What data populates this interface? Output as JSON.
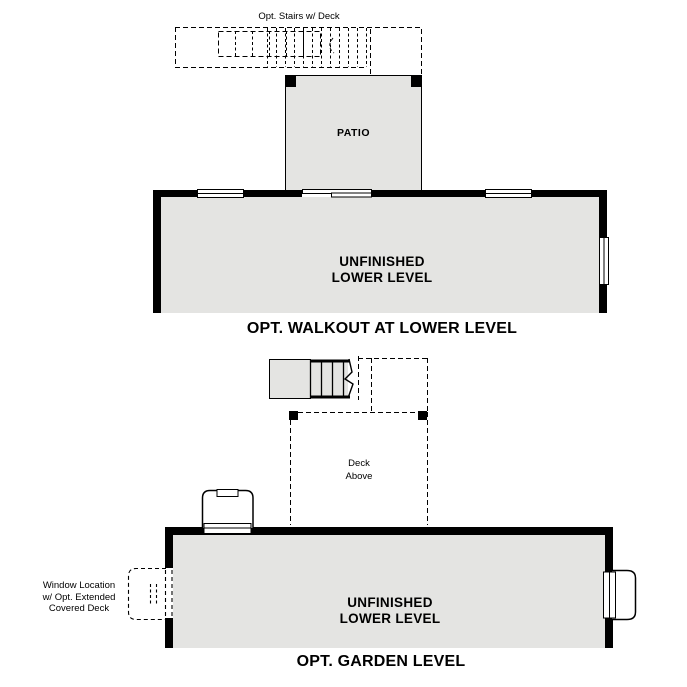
{
  "page": {
    "background_color": "#ffffff",
    "floor_fill_color": "#e4e4e2",
    "line_color": "#000000"
  },
  "walkout_plan": {
    "stairs_label": "Opt. Stairs w/ Deck",
    "patio_label": "PATIO",
    "room_label_line1": "UNFINISHED",
    "room_label_line2": "LOWER LEVEL",
    "caption": "OPT. WALKOUT AT LOWER LEVEL"
  },
  "garden_plan": {
    "deck_label_line1": "Deck",
    "deck_label_line2": "Above",
    "window_note_line1": "Window Location",
    "window_note_line2": "w/ Opt. Extended",
    "window_note_line3": "Covered Deck",
    "room_label_line1": "UNFINISHED",
    "room_label_line2": "LOWER LEVEL",
    "caption": "OPT. GARDEN LEVEL"
  }
}
